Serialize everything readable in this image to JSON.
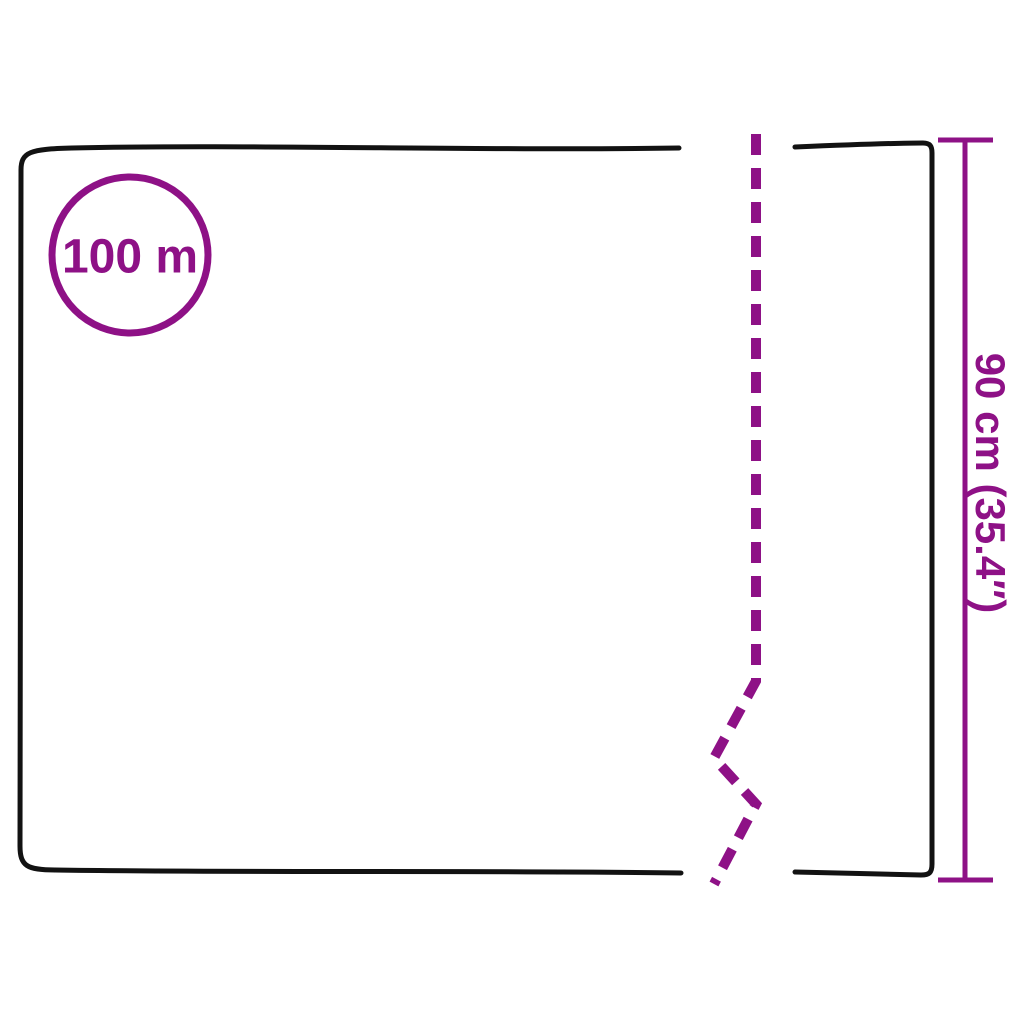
{
  "diagram": {
    "length_badge": {
      "label": "100 m"
    },
    "width_dimension": {
      "label": "90 cm (35.4″)"
    }
  },
  "colors": {
    "accent": "#8E1186",
    "outline": "#121212",
    "background": "#FFFFFF"
  }
}
